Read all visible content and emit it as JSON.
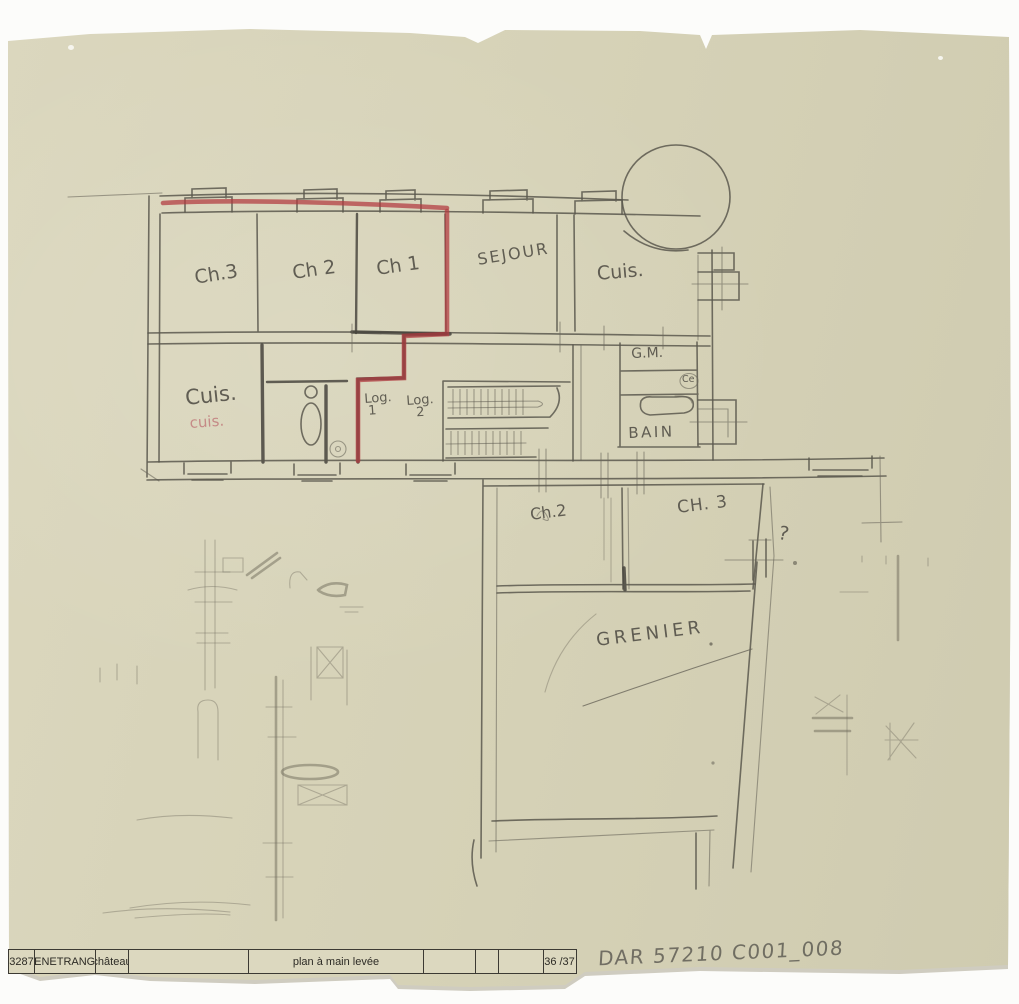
{
  "palette": {
    "paper": "#d6d2b8",
    "pencil": "#5b584d",
    "red_pencil": "#b1393f"
  },
  "upper_floor": {
    "ch3": "Ch.3",
    "ch2": "Ch 2",
    "ch1": "Ch 1",
    "sejour": "SEJOUR",
    "cuisine_right": "Cuis.",
    "gm": "G.M.",
    "ce": "Ce",
    "bain": "BAIN",
    "cuisine_left": "Cuis.",
    "cuisine_left_red": "cuis.",
    "log1_label": "Log.",
    "log1_num": "1",
    "log2_label": "Log.",
    "log2_num": "2"
  },
  "attic_floor": {
    "ch2": "Ch.2",
    "ch3": "CH. 3",
    "question": "?",
    "grenier": "GRENIER"
  },
  "title_block": {
    "number": "3287",
    "place": "FENETRANGE",
    "building": "château",
    "drawing_type": "plan à main levée",
    "sheet": "36 /37"
  },
  "annotations": {
    "reference": "DAR 57210 C001_008"
  }
}
